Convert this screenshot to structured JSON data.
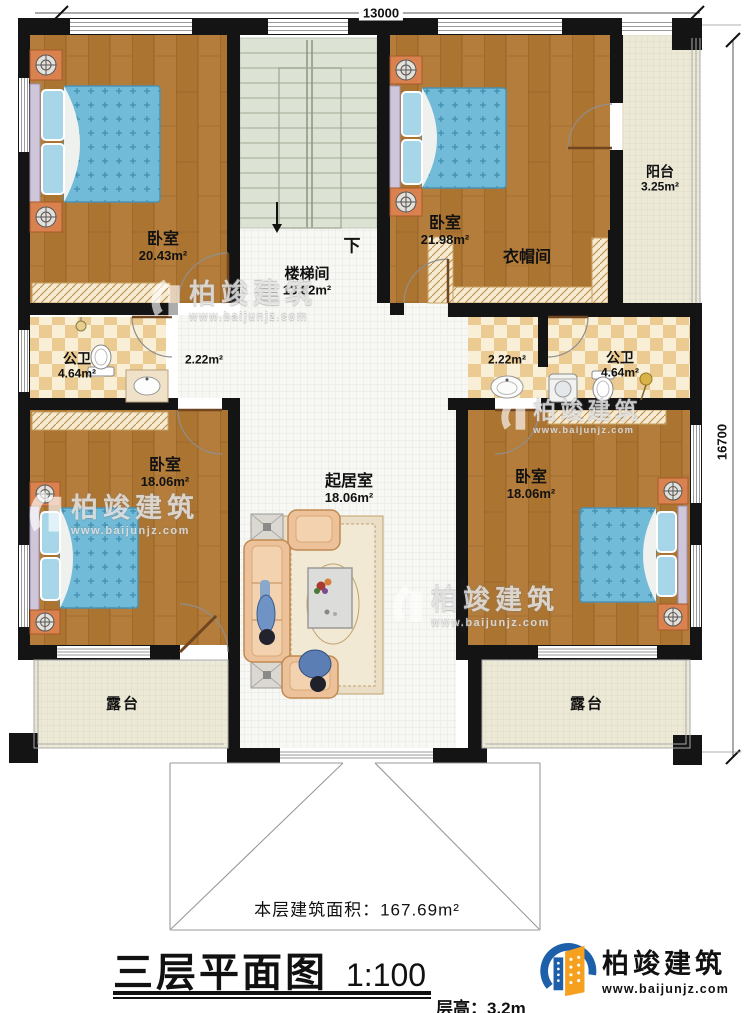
{
  "dimensions": {
    "top": "13000",
    "right": "16700"
  },
  "stairs": {
    "down_label": "下"
  },
  "rooms": {
    "bedroom_top_left": {
      "name": "卧室",
      "area": "20.43m²"
    },
    "stairwell": {
      "name": "楼梯间",
      "area": "13.82m²"
    },
    "bedroom_top_right": {
      "name": "卧室",
      "area": "21.98m²"
    },
    "cloakroom": {
      "name": "衣帽间"
    },
    "balcony": {
      "name": "阳台",
      "area": "3.25m²"
    },
    "bathroom_left": {
      "name": "公卫",
      "area": "4.64m²"
    },
    "hallway_left": {
      "area": "2.22m²"
    },
    "hallway_right": {
      "area": "2.22m²"
    },
    "bathroom_right": {
      "name": "公卫",
      "area": "4.64m²"
    },
    "bedroom_mid_left": {
      "name": "卧室",
      "area": "18.06m²"
    },
    "living_room": {
      "name": "起居室",
      "area": "18.06m²"
    },
    "bedroom_mid_right": {
      "name": "卧室",
      "area": "18.06m²"
    },
    "terrace_left": {
      "name": "露台"
    },
    "terrace_right": {
      "name": "露台"
    }
  },
  "notes": {
    "floor_area_label": "本层建筑面积：",
    "floor_area_value": "167.69m²"
  },
  "title_block": {
    "title": "三层平面图",
    "scale": "1:100",
    "floor_height_label": "层高：",
    "floor_height_value": "3.2m"
  },
  "branding": {
    "company": "柏竣建筑",
    "website": "www.baijunjz.com"
  },
  "colors": {
    "wall": "#141414",
    "wood_floor": "#b07a38",
    "tile_light": "#f8efd6",
    "tile_dark": "#eccb93",
    "stair_floor": "#dce3d5",
    "bed_blue": "#72bbd8",
    "balcony_floor": "#ece9d7",
    "logo_blue": "#1d5fa8",
    "logo_orange": "#f5a01f"
  }
}
